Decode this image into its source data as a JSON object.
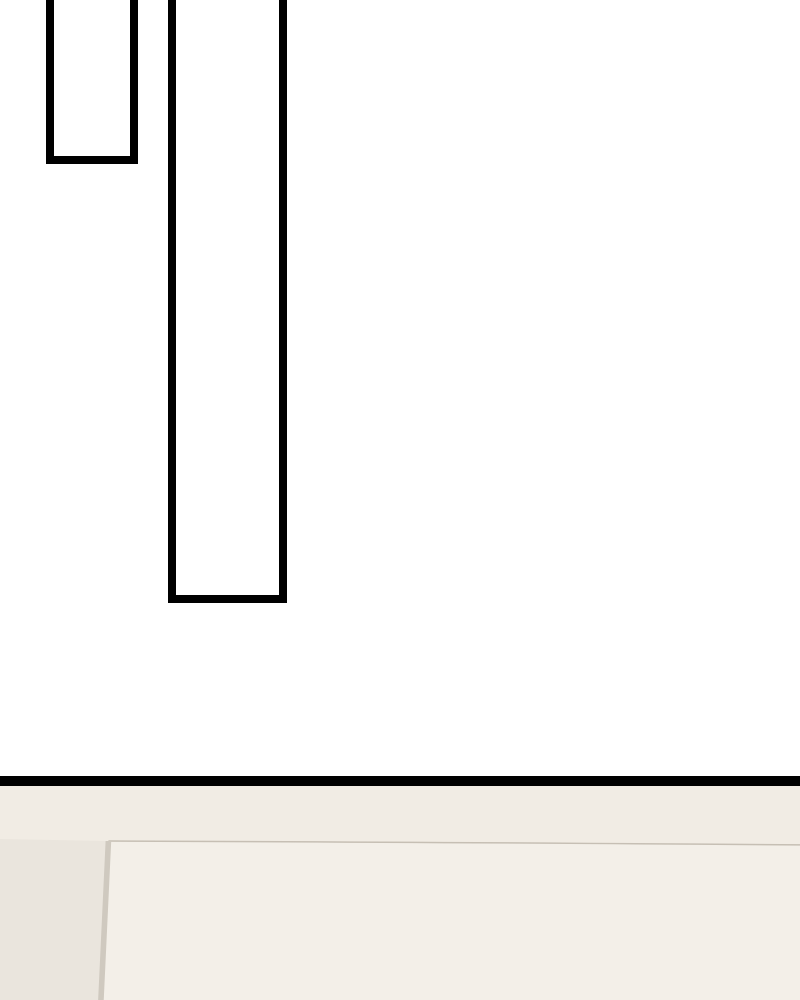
{
  "page": {
    "kind": "webtoon-comic-page",
    "text_content": "none"
  },
  "palette": {
    "page_bg": "#ffffff",
    "frame_border": "#000000",
    "frame_fill": "#ffffff",
    "divider": "#000000",
    "ceiling_wall_base": "#f1ece4",
    "outer_left_wall": "#eae5dd",
    "wall_inset_panel": "#f3efe8",
    "right_wall_top": "#e8e0d6",
    "right_wall_bottom": "#dbd2c6",
    "inset_line": "#c6bfb4",
    "inset_line_vertical": "#cfc9bf",
    "corner_line": "#8d8478",
    "ceiling_edge_line": "#756d62",
    "hair_left_fill": "#7a6d60",
    "hair_left_outline": "#554a40",
    "hair_right_fill": "#75675b",
    "hair_right_outline": "#564b41",
    "hair_right_facet": "#7f7061",
    "hair_right_streak": "#5f5246"
  },
  "scene": {
    "empty_panel_count": 2,
    "location": "room-corner-interior",
    "characters": [
      {
        "id": "left-person",
        "visible_part": "top-of-head"
      },
      {
        "id": "right-person",
        "visible_part": "top-of-head"
      }
    ]
  }
}
